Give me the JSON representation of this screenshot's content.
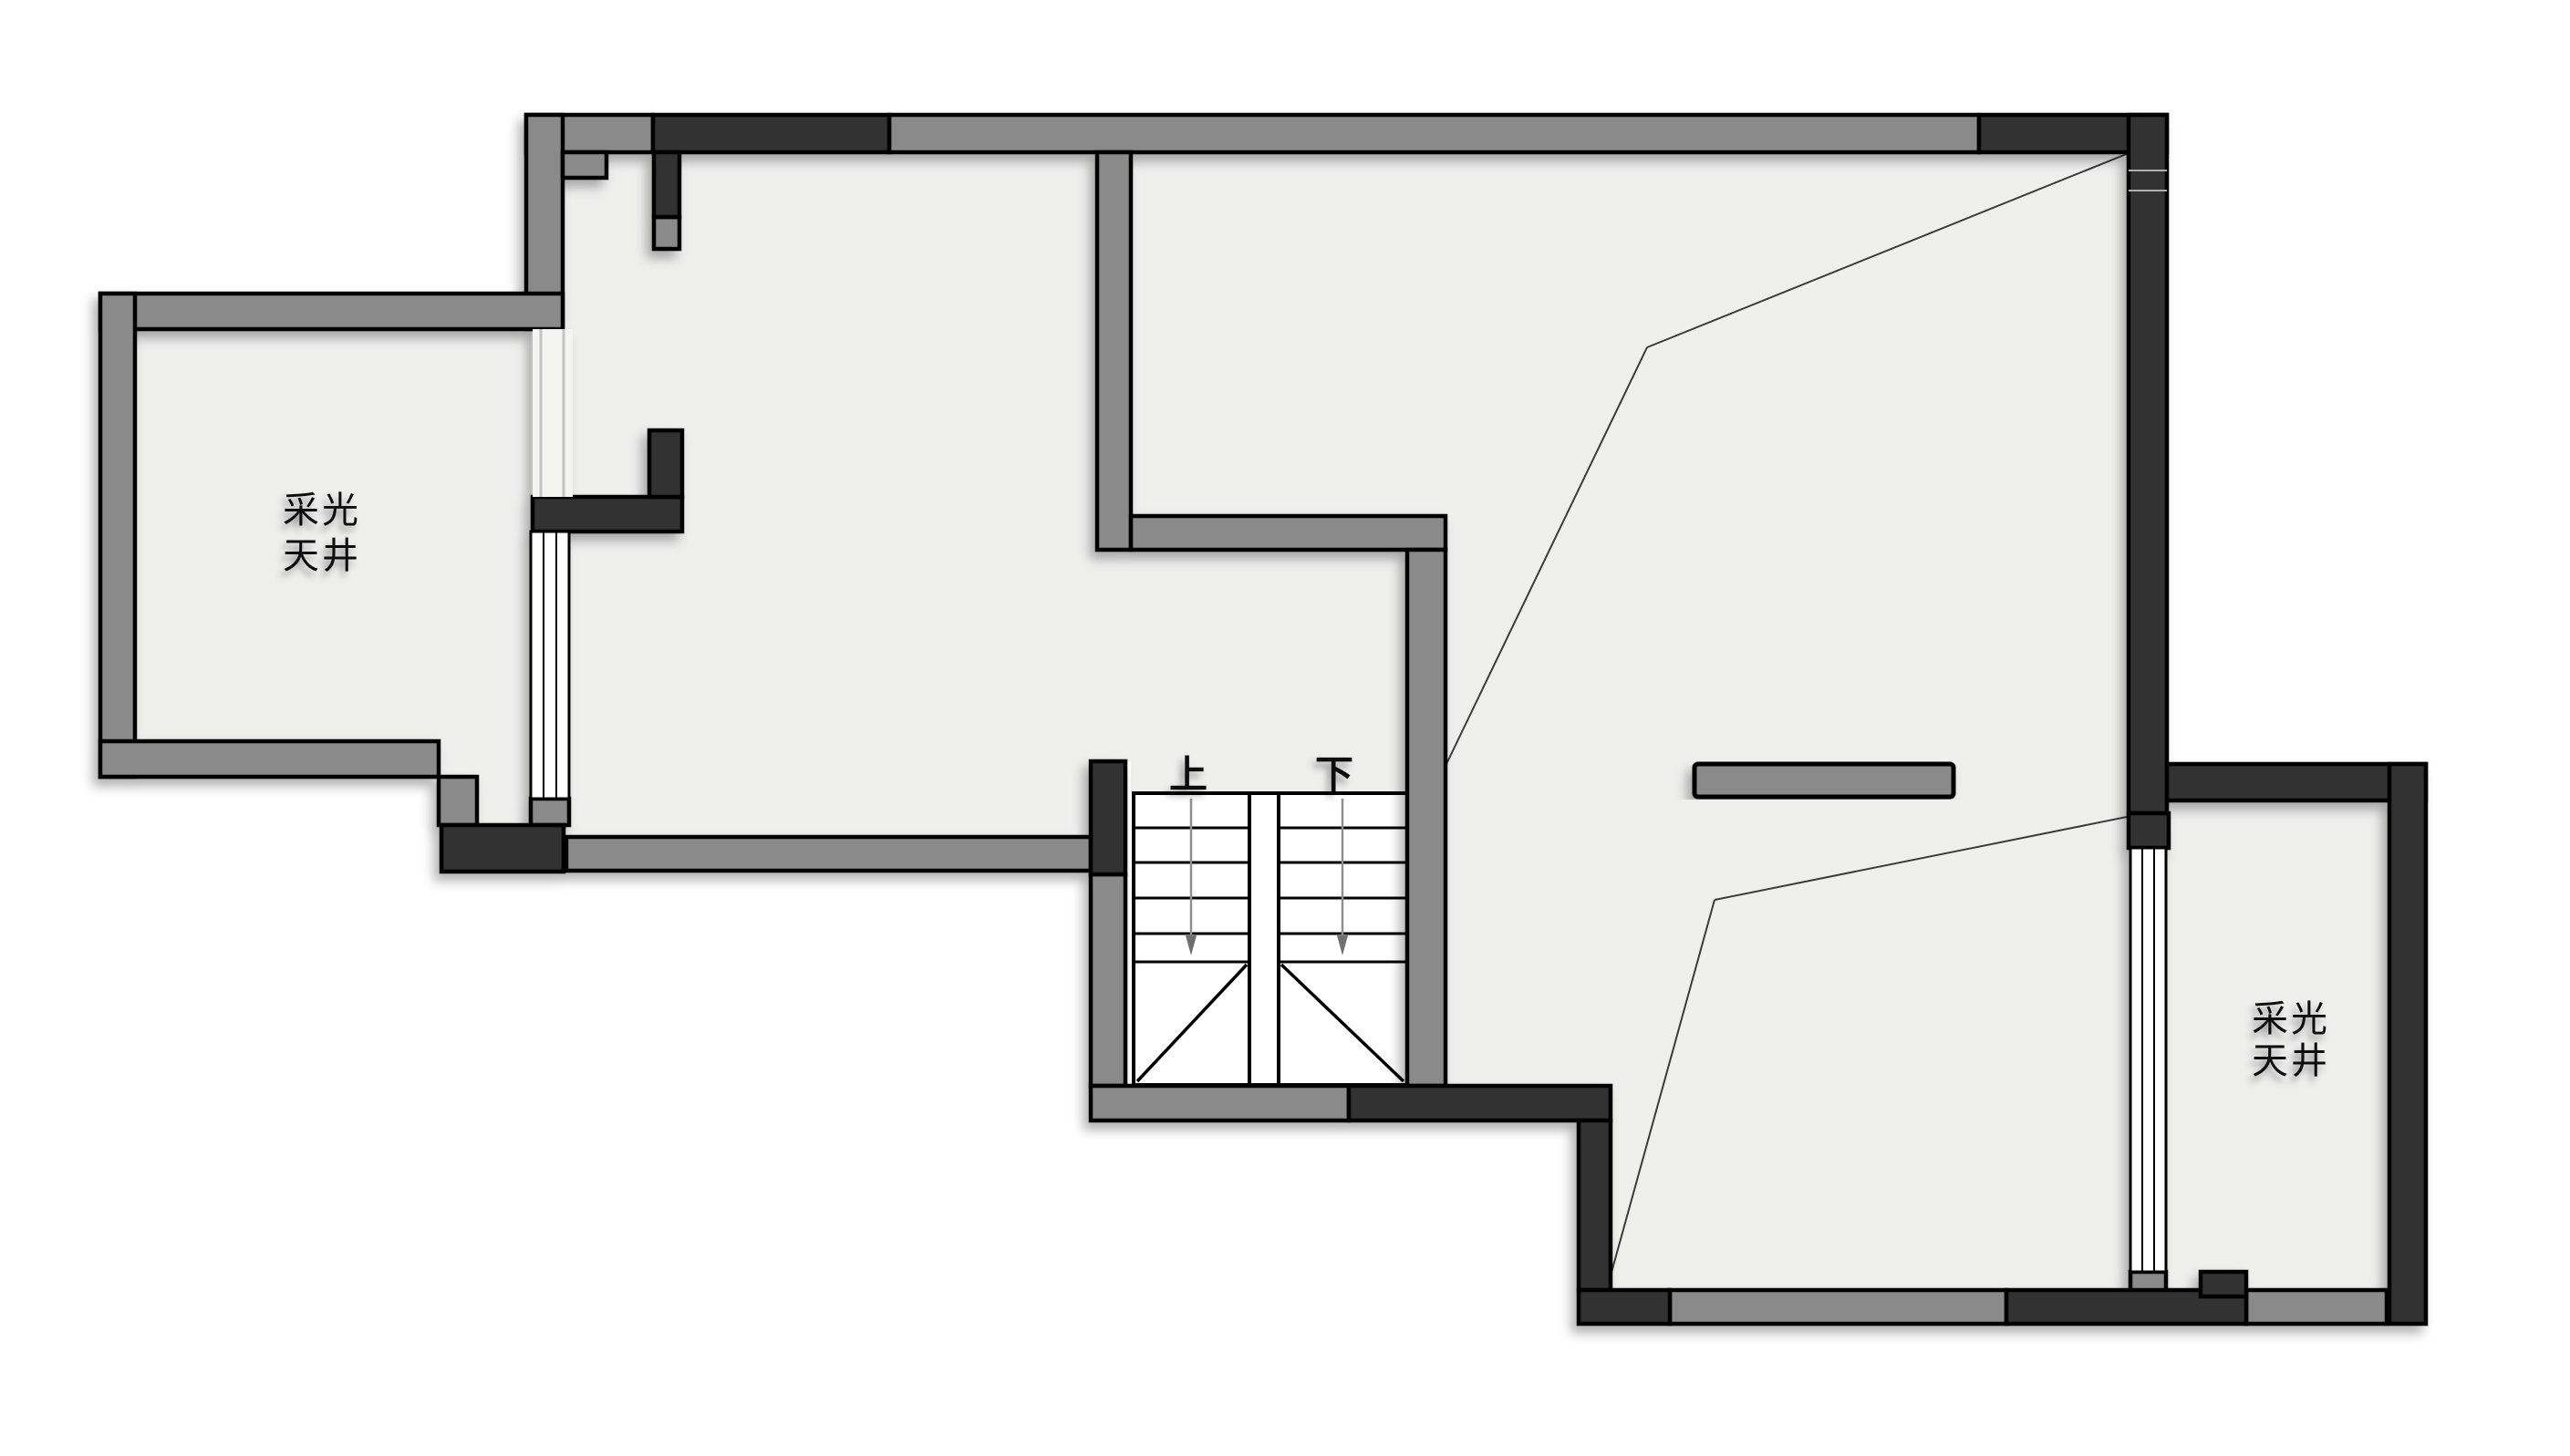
{
  "plan": {
    "background_color": "#ffffff",
    "floor_color": "#efefee",
    "wall_gray_color": "#8a8a8a",
    "wall_dark_color": "#333333",
    "outline_color": "#000000",
    "slope_line_color": "#3c3c3c",
    "labels": {
      "left_lightwell_line1": "采光",
      "left_lightwell_line2": "天井",
      "right_lightwell_line1": "采光",
      "right_lightwell_line2": "天井",
      "stairs_up": "上",
      "stairs_down": "下"
    },
    "stairs": {
      "flights": [
        {
          "name": "up-flight",
          "label": "上",
          "direction_arrow": "down"
        },
        {
          "name": "down-flight",
          "label": "下",
          "direction_arrow": "down"
        }
      ],
      "treads_per_flight": 5,
      "landing": "winder-diagonal"
    }
  }
}
